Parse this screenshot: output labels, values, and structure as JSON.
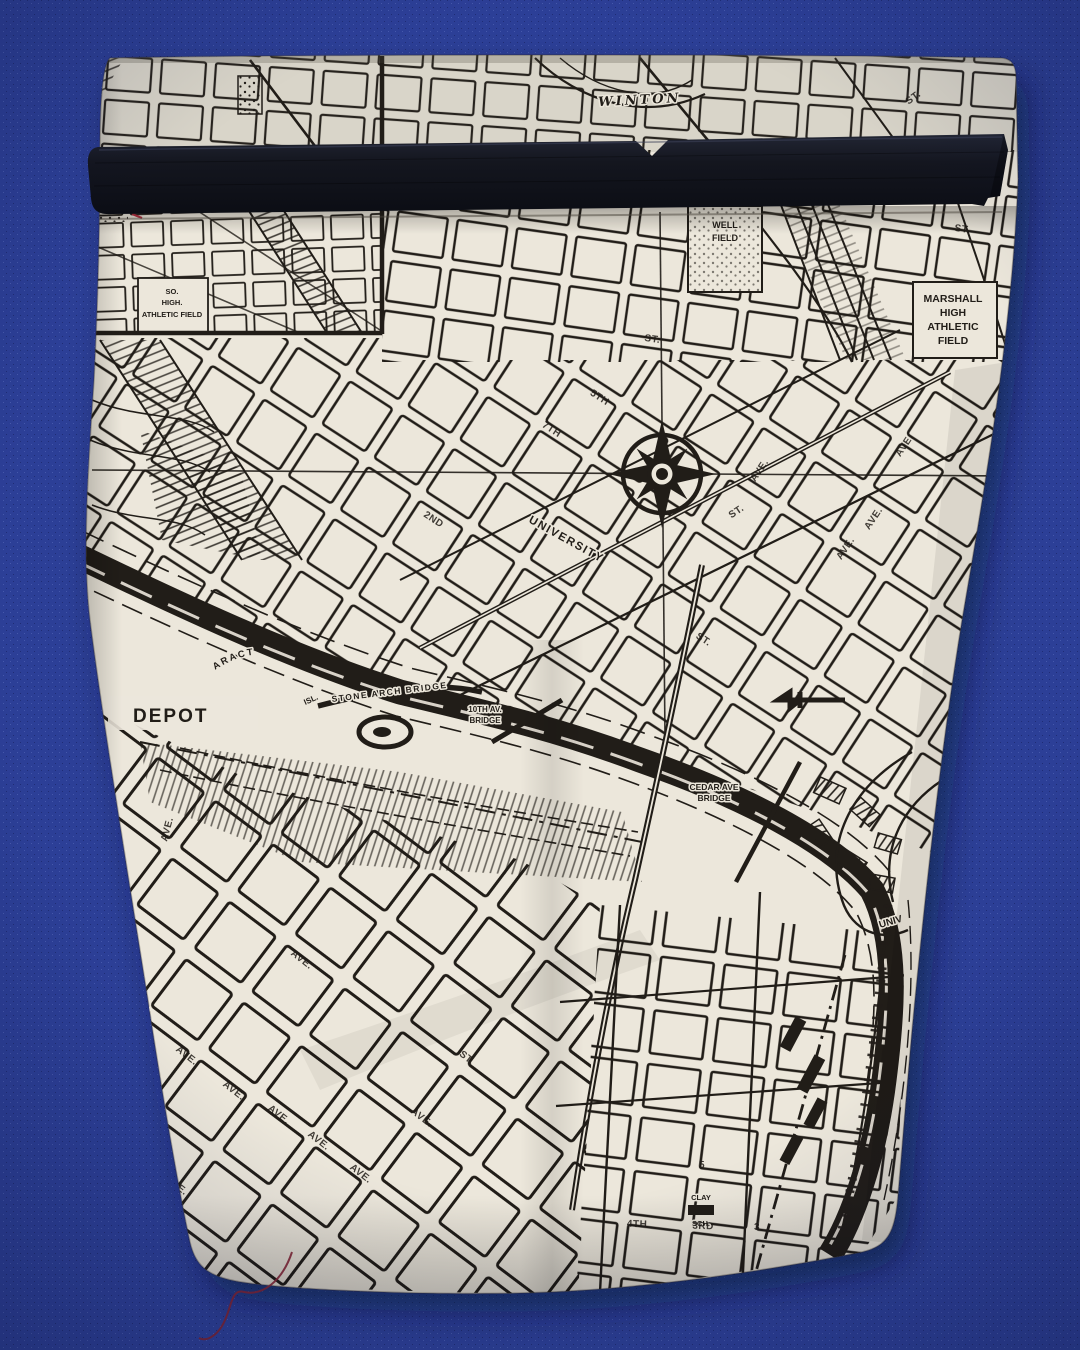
{
  "scene": {
    "type": "photograph",
    "subject": "Roll-top fabric pouch printed with a vintage black-and-white city street map, closed by a black strap, lying on royal blue canvas",
    "colors": {
      "background": "#2c3f97",
      "map_fabric": "#ece7db",
      "map_ink": "#211d18",
      "strap": "#14161d",
      "loose_thread": "#7b2433"
    }
  },
  "map": {
    "labels": {
      "winton": "WINTON",
      "marshall": [
        "MARSHALL",
        "HIGH",
        "ATHLETIC",
        "FIELD"
      ],
      "lowell": [
        "WELL",
        "FIELD"
      ],
      "so_high": [
        "SO.",
        "HIGH.",
        "ATHLETIC FIELD"
      ],
      "depot": "DEPOT",
      "cataract": "CATARACT",
      "isl": "ISL.",
      "stone_arch": "STONE ARCH BRIDGE",
      "tenth_av": [
        "10TH AV.",
        "BRIDGE"
      ],
      "cedar": [
        "CEDAR AVE",
        "BRIDGE"
      ],
      "university": "UNIVERSITY",
      "hospital": [
        "CITY",
        "HOSPITAL"
      ],
      "clay": [
        "CLAY",
        "SCH."
      ],
      "univ_partial": "UNIV"
    },
    "street_labels": [
      "AVE.",
      "AVE.",
      "AVE.",
      "AVE.",
      "AVE.",
      "AVE.",
      "AVE.",
      "AVE.",
      "AVE.",
      "4TH",
      "3RD",
      "5",
      "3",
      "ST.",
      "ST.",
      "ST.",
      "ST.",
      "AVE.",
      "AVE.",
      "7TH",
      "5TH",
      "2ND",
      "ST.",
      "AVE.",
      "AVE.",
      "ST."
    ]
  }
}
